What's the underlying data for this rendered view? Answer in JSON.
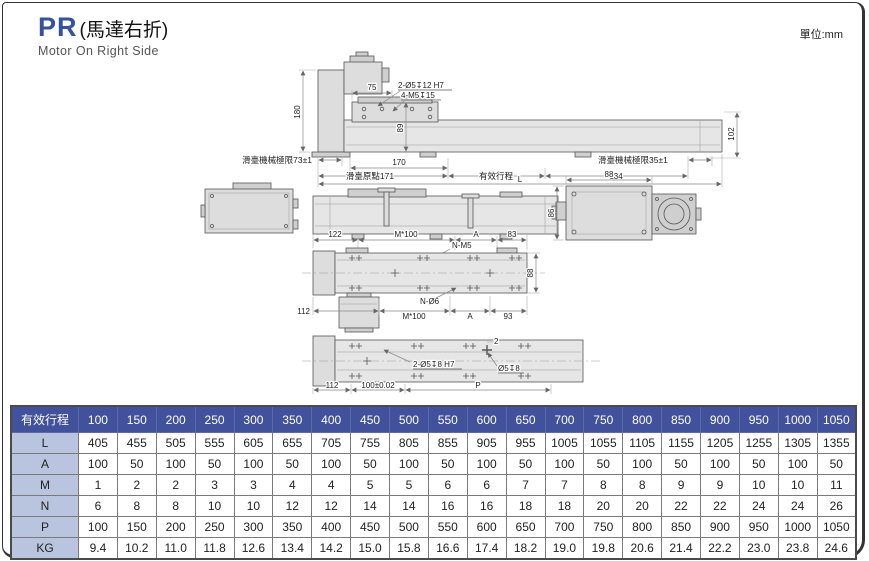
{
  "page": {
    "series": "PR",
    "title_cn": "(馬達右折)",
    "subtitle": "Motor On Right Side",
    "unit_label": "單位:mm"
  },
  "colors": {
    "accent_blue": "#35519f",
    "table_header_bg": "#42519b",
    "table_label_bg": "#b9c5de",
    "drawing_fill": "#dddddd"
  },
  "drawings": {
    "top": {
      "d180": "180",
      "d75": "75",
      "holes_a": "2-Ø5↧12 H7",
      "holes_b": "4-M5↧15",
      "d89": "89",
      "d102": "102",
      "limit_left": "滑臺機械極限73±1",
      "d170": "170",
      "origin": "滑臺原點171",
      "stroke": "有效行程",
      "d134": "134",
      "limit_right": "滑臺機械極限35±1",
      "dL": "L"
    },
    "plan": {
      "d122": "122",
      "m100_top": "M*100",
      "a_top": "A",
      "d83": "83",
      "n_m5": "N-M5",
      "d88": "88",
      "d112": "112",
      "n_o6": "N-Ø6",
      "m100_bot": "M*100",
      "a_bot": "A",
      "d93": "93"
    },
    "end": {
      "d88": "88",
      "d86": "86"
    },
    "bottom": {
      "holes": "2-Ø5↧8 H7",
      "counterbore": "Ø5↧8",
      "d2": "2",
      "d112": "112",
      "d100": "100±0.02",
      "dP": "P"
    }
  },
  "table": {
    "header_label": "有效行程",
    "strokes": [
      "100",
      "150",
      "200",
      "250",
      "300",
      "350",
      "400",
      "450",
      "500",
      "550",
      "600",
      "650",
      "700",
      "750",
      "800",
      "850",
      "900",
      "950",
      "1000",
      "1050"
    ],
    "rows": [
      {
        "label": "L",
        "values": [
          "405",
          "455",
          "505",
          "555",
          "605",
          "655",
          "705",
          "755",
          "805",
          "855",
          "905",
          "955",
          "1005",
          "1055",
          "1105",
          "1155",
          "1205",
          "1255",
          "1305",
          "1355"
        ]
      },
      {
        "label": "A",
        "values": [
          "100",
          "50",
          "100",
          "50",
          "100",
          "50",
          "100",
          "50",
          "100",
          "50",
          "100",
          "50",
          "100",
          "50",
          "100",
          "50",
          "100",
          "50",
          "100",
          "50"
        ]
      },
      {
        "label": "M",
        "values": [
          "1",
          "2",
          "2",
          "3",
          "3",
          "4",
          "4",
          "5",
          "5",
          "6",
          "6",
          "7",
          "7",
          "8",
          "8",
          "9",
          "9",
          "10",
          "10",
          "11"
        ]
      },
      {
        "label": "N",
        "values": [
          "6",
          "8",
          "8",
          "10",
          "10",
          "12",
          "12",
          "14",
          "14",
          "16",
          "16",
          "18",
          "18",
          "20",
          "20",
          "22",
          "22",
          "24",
          "24",
          "26"
        ]
      },
      {
        "label": "P",
        "values": [
          "100",
          "150",
          "200",
          "250",
          "300",
          "350",
          "400",
          "450",
          "500",
          "550",
          "600",
          "650",
          "700",
          "750",
          "800",
          "850",
          "900",
          "950",
          "1000",
          "1050"
        ]
      },
      {
        "label": "KG",
        "values": [
          "9.4",
          "10.2",
          "11.0",
          "11.8",
          "12.6",
          "13.4",
          "14.2",
          "15.0",
          "15.8",
          "16.6",
          "17.4",
          "18.2",
          "19.0",
          "19.8",
          "20.6",
          "21.4",
          "22.2",
          "23.0",
          "23.8",
          "24.6"
        ]
      }
    ]
  }
}
